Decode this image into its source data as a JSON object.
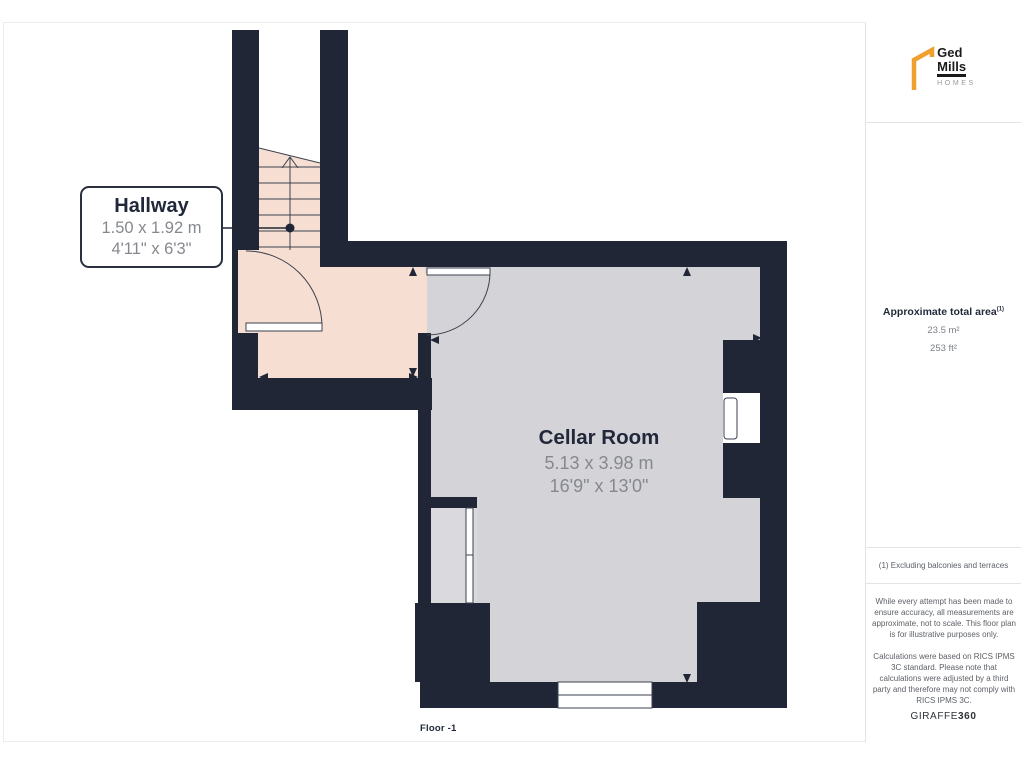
{
  "floor_label": "Floor -1",
  "rooms": [
    {
      "name": "Hallway",
      "metric": "1.50 x 1.92 m",
      "imperial": "4'11\" x 6'3\""
    },
    {
      "name": "Cellar Room",
      "metric": "5.13 x 3.98 m",
      "imperial": "16'9\" x 13'0\""
    }
  ],
  "sidebar": {
    "logo": {
      "line1": "Ged",
      "line2": "Mills",
      "line3": "HOMES"
    },
    "area": {
      "title": "Approximate total area",
      "sup": "(1)",
      "metric": "23.5 m²",
      "imperial": "253 ft²"
    },
    "footnote": "(1) Excluding balconies and terraces",
    "disclaimer1": "While every attempt has been made to ensure accuracy, all measurements are approximate, not to scale. This floor plan is for illustrative purposes only.",
    "disclaimer2": "Calculations were based on RICS IPMS 3C standard. Please note that calculations were adjusted by a third party and therefore may not comply with RICS IPMS 3C.",
    "brand": {
      "name": "GIRAFFE",
      "suffix": "360"
    }
  },
  "colors": {
    "wall": "#202636",
    "peach": "#f6dfd2",
    "room": "#d4d4d8",
    "niche": "#dadade",
    "line": "#3c4150",
    "orange": "#efa02f",
    "title": "#20283a",
    "dim": "#85888e",
    "muted": "#5d6167",
    "divider": "#e3e3e7"
  }
}
